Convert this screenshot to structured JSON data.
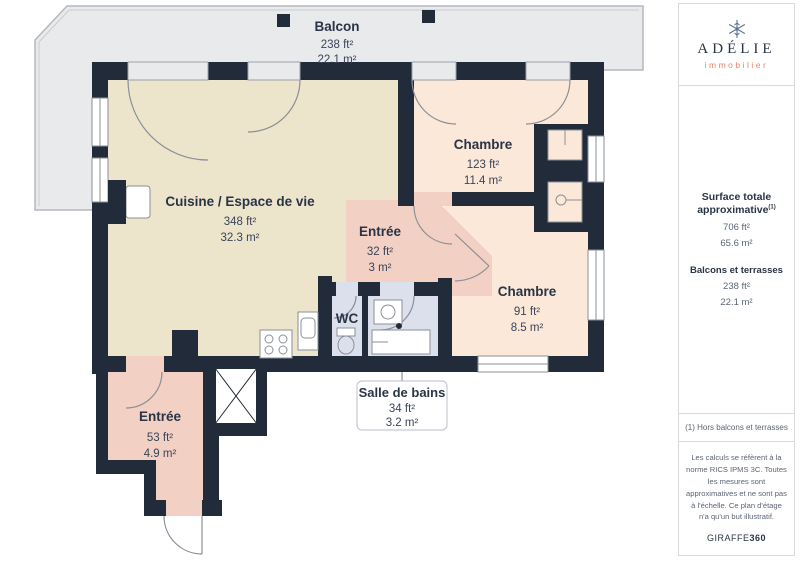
{
  "plan": {
    "rooms": {
      "balcon": {
        "name": "Balcon",
        "ft": "238 ft²",
        "m": "22.1 m²"
      },
      "cuisine": {
        "name": "Cuisine / Espace de vie",
        "ft": "348 ft²",
        "m": "32.3 m²"
      },
      "chambre1": {
        "name": "Chambre",
        "ft": "123 ft²",
        "m": "11.4 m²"
      },
      "entree_milieu": {
        "name": "Entrée",
        "ft": "32 ft²",
        "m": "3 m²"
      },
      "chambre2": {
        "name": "Chambre",
        "ft": "91 ft²",
        "m": "8.5 m²"
      },
      "wc": {
        "name": "WC"
      },
      "salle_de_bains": {
        "name": "Salle de bains",
        "ft": "34 ft²",
        "m": "3.2 m²"
      },
      "entree_bas": {
        "name": "Entrée",
        "ft": "53 ft²",
        "m": "4.9 m²"
      }
    },
    "colors": {
      "wall": "#222B3A",
      "living": "#EDE4CC",
      "bedroom": "#FBE8D8",
      "entree": "#F2D0C3",
      "wet": "#DCE0ED",
      "balcony": "#E9EAEC"
    }
  },
  "sidebar": {
    "brand": {
      "name": "ADÉLIE",
      "tagline": "immobilier"
    },
    "surface_totale": {
      "label": "Surface totale approximative",
      "sup": "(1)",
      "ft": "706 ft²",
      "m": "65.6 m²"
    },
    "balcons": {
      "label": "Balcons et terrasses",
      "ft": "238 ft²",
      "m": "22.1 m²"
    },
    "note": "(1) Hors balcons et terrasses",
    "legal": "Les calculs se réfèrent à la norme RICS IPMS 3C. Toutes les mesures sont approximatives et ne sont pas à l'échelle. Ce plan d'étage n'a qu'un but illustratif.",
    "credit_regular": "GIRAFFE",
    "credit_bold": "360"
  }
}
